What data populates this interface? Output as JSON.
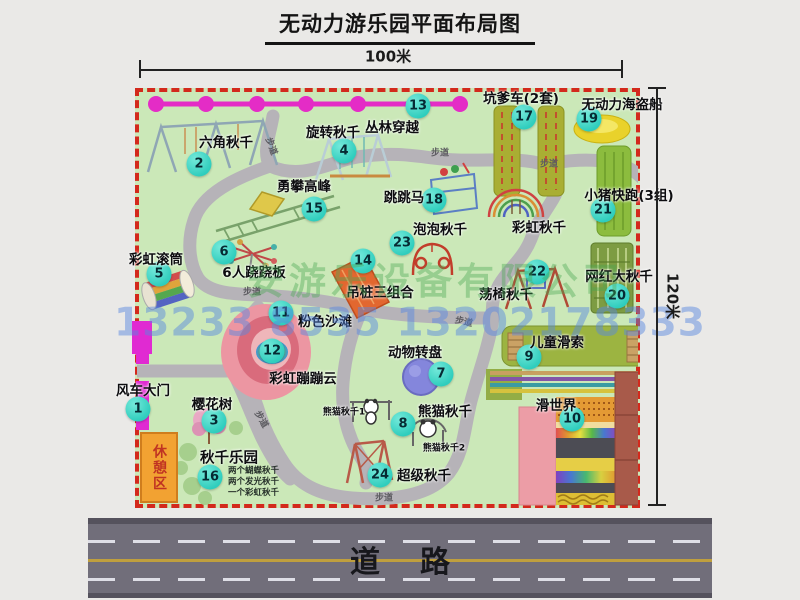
{
  "title": "无动力游乐园平面布局图",
  "dimensions": {
    "width_label": "100米",
    "height_label": "120米"
  },
  "road_label": "道路",
  "trail_label": "步道",
  "rest_area_label": "休憩区",
  "watermark": {
    "company": "安游乐设备有限公司",
    "phone": "13233 8535 13202178333"
  },
  "attractions": [
    {
      "num": "1",
      "name": "风车大门"
    },
    {
      "num": "2",
      "name": "六角秋千"
    },
    {
      "num": "3",
      "name": "樱花树"
    },
    {
      "num": "4",
      "name": "旋转秋千"
    },
    {
      "num": "5",
      "name": "彩虹滚筒"
    },
    {
      "num": "6",
      "name": "6人跷跷板"
    },
    {
      "num": "7",
      "name": "动物转盘"
    },
    {
      "num": "8",
      "name": "熊猫秋千"
    },
    {
      "num": "9",
      "name": "儿童滑索"
    },
    {
      "num": "10",
      "name": "滑世界"
    },
    {
      "num": "11",
      "name": "粉色沙滩"
    },
    {
      "num": "12",
      "name": "彩虹蹦蹦云"
    },
    {
      "num": "13",
      "name": "丛林穿越"
    },
    {
      "num": "14",
      "name": "吊桩三组合"
    },
    {
      "num": "15",
      "name": "勇攀高峰"
    },
    {
      "num": "16",
      "name": "秋千乐园"
    },
    {
      "num": "17",
      "name": "坑爹车(2套)"
    },
    {
      "num": "18",
      "name": "跳跳马"
    },
    {
      "num": "19",
      "name": "无动力海盗船"
    },
    {
      "num": "20",
      "name": "网红大秋千"
    },
    {
      "num": "21",
      "name": "小猪快跑(3组)"
    },
    {
      "num": "22",
      "name": "荡椅秋千"
    },
    {
      "num": "23",
      "name": "泡泡秋千"
    },
    {
      "num": "24",
      "name": "超级秋千"
    }
  ],
  "extra_labels": {
    "rainbow_swing": "彩虹秋千",
    "panda_swing_1": "熊猫秋千1",
    "panda_swing_2": "熊猫秋千2",
    "swing_park_note_1": "两个蝴蝶秋千",
    "swing_park_note_2": "两个发光秋千",
    "swing_park_note_3": "一个彩虹秋千"
  },
  "colors": {
    "map_bg": "#cbe8b8",
    "border_dash": "#d3291c",
    "badge": "#3ed8c8",
    "jungle_line": "#e42cc6",
    "road": "#716e7a",
    "gate": "#e02ad2",
    "rest_area": "#f2a232"
  }
}
